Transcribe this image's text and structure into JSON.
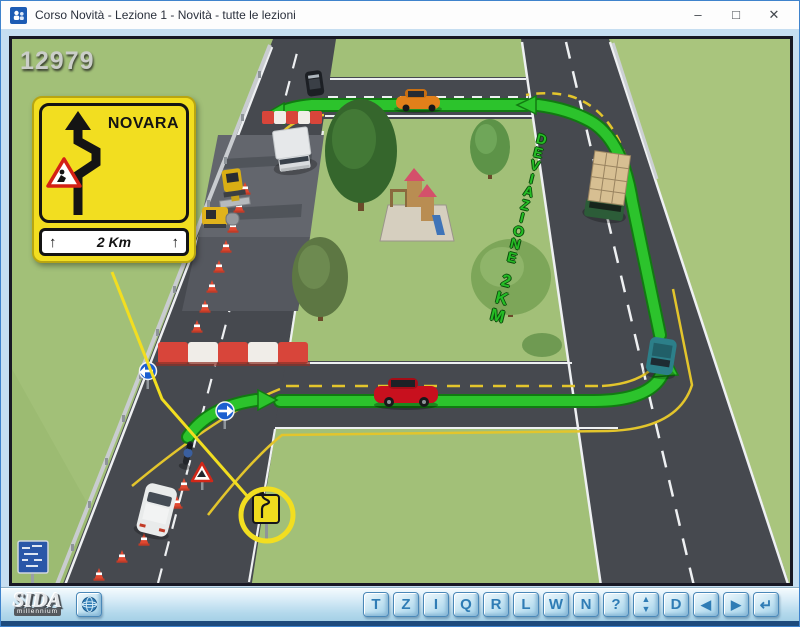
{
  "window": {
    "title": "Corso Novità - Lezione 1 - Novità - tutte le lezioni",
    "icon": "people-icon",
    "controls": {
      "minimize": "–",
      "maximize": "□",
      "close": "✕"
    }
  },
  "scene": {
    "image_number": "12979",
    "detour_sign": {
      "destination": "NOVARA",
      "distance": "2 Km",
      "arrow_left": "↑",
      "arrow_right": "↑"
    },
    "road_text": {
      "word1": "DEVIAZIONE",
      "word2": "2KM"
    }
  },
  "toolbar": {
    "logo_text": "SIDA",
    "logo_subtext": "millennium",
    "buttons": [
      "T",
      "Z",
      "I",
      "Q",
      "R",
      "L",
      "W",
      "N",
      "?"
    ],
    "spinner": {
      "up": "▲",
      "down": "▼"
    },
    "nav_buttons": [
      "D",
      "◀",
      "▶",
      "↵"
    ]
  },
  "colors": {
    "path_green": "#2cc32c",
    "temp_marking_yellow": "#e3c52c",
    "callout_yellow": "#f2de20",
    "barrier_red": "#d8453a",
    "button_text_blue": "#2f7cb5",
    "frame_light_blue": "#c6def1",
    "scene_border": "#181824"
  }
}
